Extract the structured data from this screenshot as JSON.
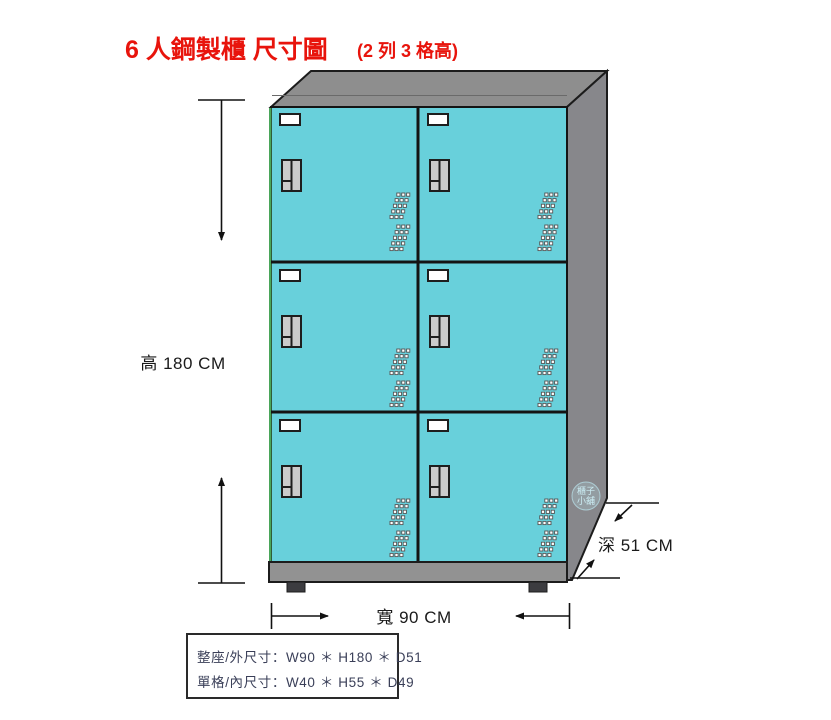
{
  "title": {
    "main": "6 人鋼製櫃 尺寸圖",
    "sub": "(2 列 3 格高)"
  },
  "dimensions": {
    "height_label": "高 180 CM",
    "width_label": "寬 90 CM",
    "depth_label": "深 51 CM"
  },
  "spec_box": {
    "line1": "整座/外尺寸：W90 ＊ H180 ＊ D51",
    "line2": "單格/內尺寸：W40 ＊ H55 ＊ D49"
  },
  "watermark": {
    "line1": "櫃子",
    "line2": "小舖"
  },
  "cabinet": {
    "columns": 2,
    "rows": 3,
    "door_count": 6
  },
  "colors": {
    "title_red": "#e8140c",
    "door_cyan": "#68d0db",
    "cabinet_top_gray": "#8e8e8e",
    "cabinet_side_gray": "#87878b",
    "base_gray": "#929292",
    "outline": "#1a1a1a",
    "spec_text": "#3a3f58"
  }
}
